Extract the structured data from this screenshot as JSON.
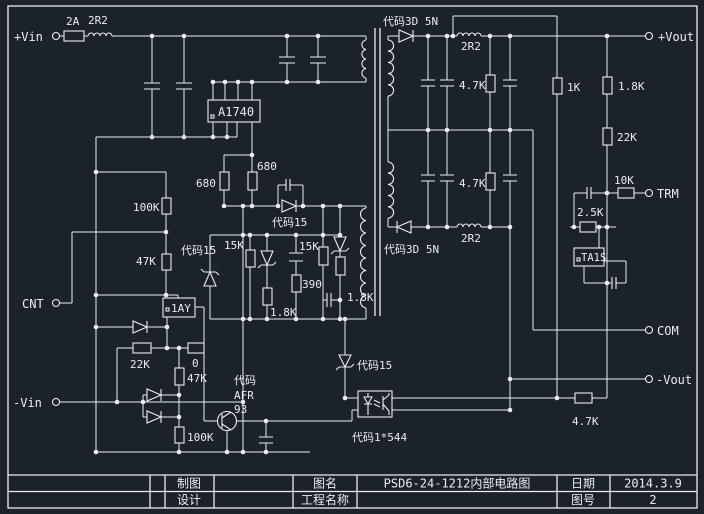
{
  "accent_colors": {
    "background": "#1c222c",
    "line": "#e9edf2"
  },
  "terminals": {
    "vin_pos": "+Vin",
    "cnt": "CNT",
    "vin_neg": "-Vin",
    "vout_pos": "+Vout",
    "trm": "TRM",
    "com": "COM",
    "vout_neg": "-Vout"
  },
  "labels": {
    "fuse": "2A",
    "ind_in": "2R2",
    "ic_pwm": "A1740",
    "r680_a": "680",
    "r680_b": "680",
    "d_code15_a": "代码15",
    "d_code15_b": "代码15",
    "d_code15_c": "代码15",
    "r100k_a": "100K",
    "r47k_a": "47K",
    "r15k_a": "15K",
    "r15k_b": "15K",
    "r390": "390",
    "r1k8_a": "1.8K",
    "r1k8_b": "1.8K",
    "ic_ref": "1AY",
    "r22k_a": "22K",
    "r0": "0",
    "r47k_b": "47K",
    "r100k_b": "100K",
    "q_line1": "代码",
    "q_line2": "AFR",
    "q_line3": "93",
    "opto": "代码1*544",
    "d3d5n_a": "代码3D 5N",
    "d3d5n_b": "代码3D 5N",
    "ind_sec_a": "2R2",
    "ind_sec_b": "2R2",
    "r4k7_a": "4.7K",
    "r4k7_b": "4.7K",
    "r4k7_c": "4.7K",
    "r1k": "1K",
    "r1k8_c": "1.8K",
    "r22k_b": "22K",
    "r10k": "10K",
    "r2k5": "2.5K",
    "ic_shunt": "TA1S"
  },
  "title_block": {
    "drafter_label": "制图",
    "designer_label": "设计",
    "drawing_name_label": "图名",
    "drawing_name": "PSD6-24-1212内部电路图",
    "project_label": "工程名称",
    "date_label": "日期",
    "date_value": "2014.3.9",
    "sheet_label": "图号",
    "sheet_value": "2"
  }
}
